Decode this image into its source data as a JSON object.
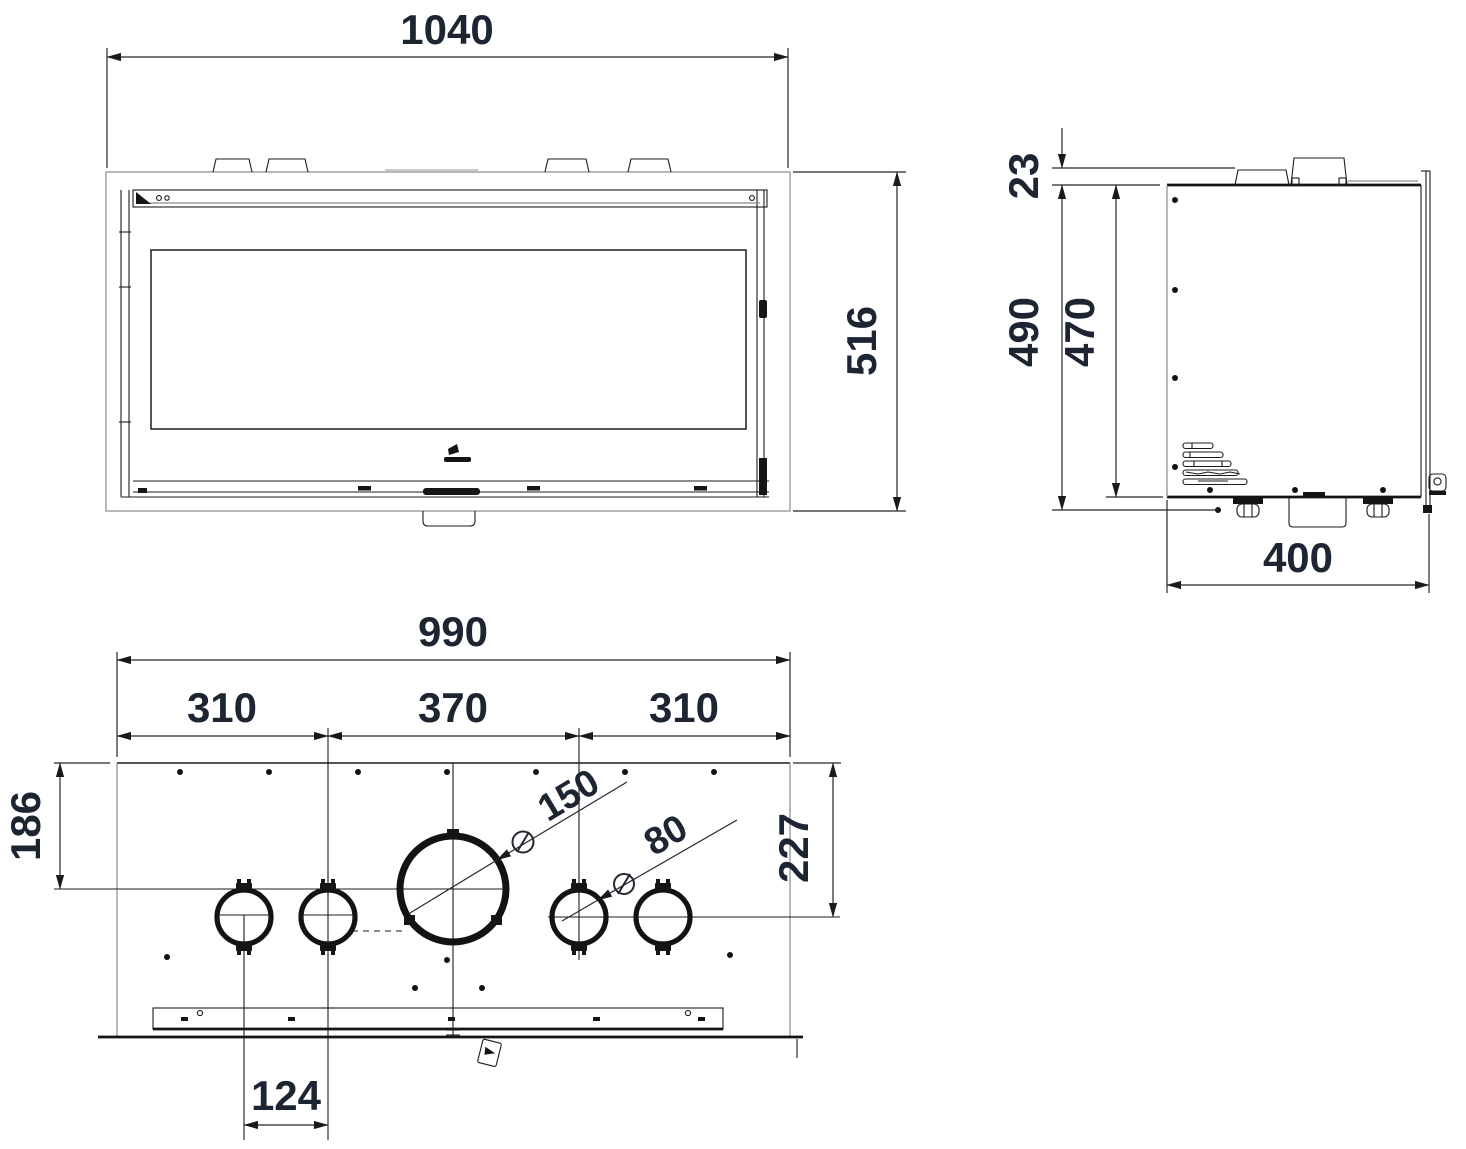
{
  "front_view": {
    "width": "1040",
    "height": "516"
  },
  "side_view": {
    "bracket_height": "23",
    "overall_height": "490",
    "body_height": "470",
    "depth": "400"
  },
  "top_view": {
    "overall_width": "990",
    "left_section": "310",
    "middle_section": "370",
    "right_section": "310",
    "flue_centre_offset": "186",
    "duct_centre_offset": "227",
    "duct_spacing": "124",
    "diameter_symbol": "⌀",
    "flue_diameter": "150",
    "duct_diameter": "80"
  }
}
